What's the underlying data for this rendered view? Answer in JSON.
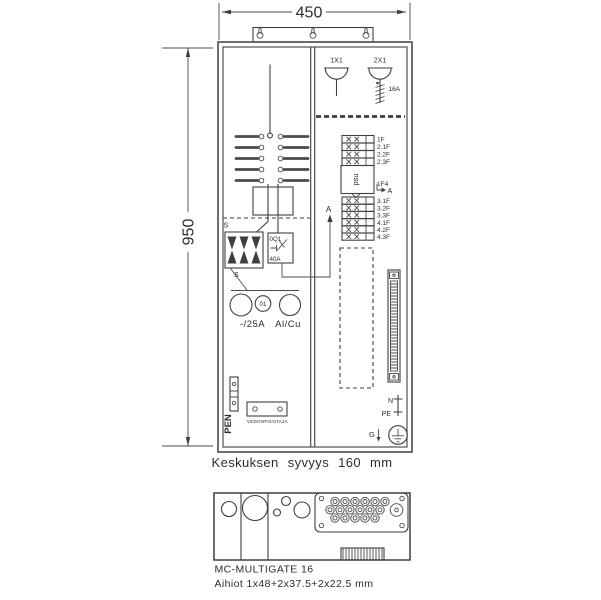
{
  "drawing": {
    "dim_width": "450",
    "dim_height": "950",
    "depth_note": "Keskuksen syvyys 160 mm"
  },
  "lamps": {
    "socket1": "1X1",
    "socket2": "2X1",
    "fuse": "16A"
  },
  "breakers": {
    "group1": [
      "1F",
      "2.1F",
      "2.2F",
      "2.3F"
    ],
    "meter": "psu",
    "meter_ref": "1F4",
    "group2": [
      "3.1F",
      "3.2F",
      "3.3F",
      "4.1F",
      "4.2F",
      "4.3F"
    ]
  },
  "section": {
    "label_a_left": "A",
    "label_a_right": "A",
    "s_top": "S",
    "s_fuse": "S"
  },
  "main_switch": {
    "designation": "0Q1",
    "rating": "40A",
    "handle": "01",
    "supply_rating": "-/25A",
    "conductor": "Al/Cu"
  },
  "terminals": {
    "pen": "PEN",
    "strain_relief": "VEDONPOISTAJA",
    "n": "N",
    "pe": "PE",
    "g": "G"
  },
  "gland_plate": {
    "product": "MC-MULTIGATE 16",
    "blanks": "Aihiot 1x48+2x37.5+2x22.5 mm"
  }
}
